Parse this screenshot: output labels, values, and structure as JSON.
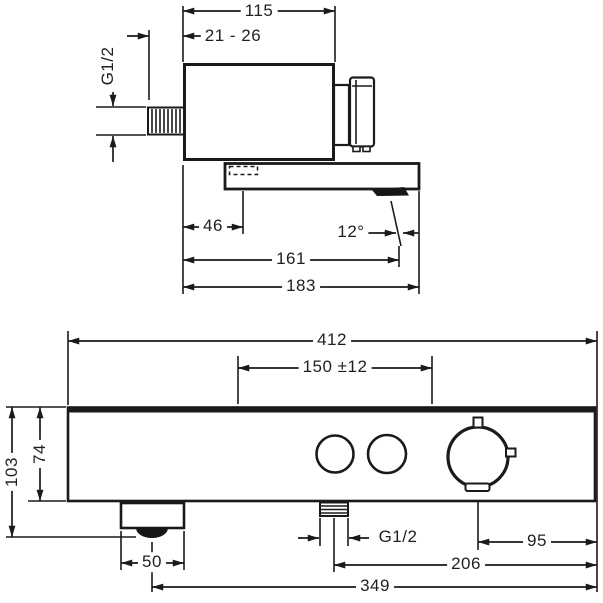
{
  "colors": {
    "background": "#ffffff",
    "line": "#1a1a1a",
    "text": "#1f1f1f"
  },
  "top_view": {
    "description": "side view of wall-mounted thermostatic bath mixer",
    "dims": {
      "body_width": "115",
      "wall_clearance": "21 - 26",
      "inlet_thread": "G1/2",
      "outlet_offset": "46",
      "spout_angle": "12°",
      "spout_reach": "161",
      "total_reach": "183"
    }
  },
  "front_view": {
    "description": "front view of mixer body with buttons, thermostat dial and spout",
    "dims": {
      "total_width": "412",
      "connection_centers": "150 ±12",
      "total_height": "103",
      "body_height": "74",
      "spout_width": "50",
      "bottom_thread": "G1/2",
      "dial_to_edge": "95",
      "thread_to_edge": "206",
      "spout_to_edge": "349"
    }
  }
}
